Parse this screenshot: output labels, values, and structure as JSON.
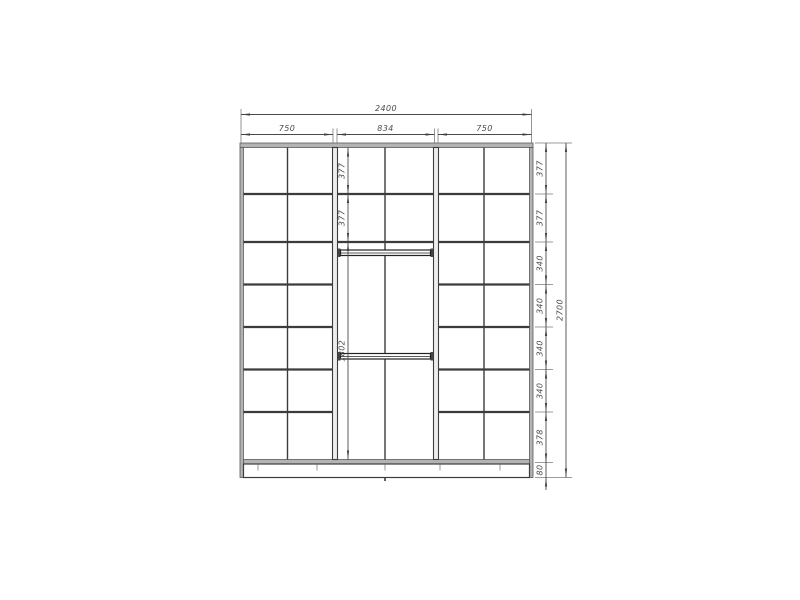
{
  "drawing": {
    "type": "wardrobe-front-elevation",
    "line_color": "#3c3c3c",
    "dim_color": "#4a4a4a",
    "dims": {
      "overall_width": "2400",
      "sections": [
        "750",
        "834",
        "750"
      ],
      "heights": [
        "377",
        "377",
        "340",
        "340",
        "340",
        "340",
        "378",
        "80"
      ],
      "overall_height": "2700",
      "middle": [
        "377",
        "377",
        "1802"
      ]
    }
  }
}
